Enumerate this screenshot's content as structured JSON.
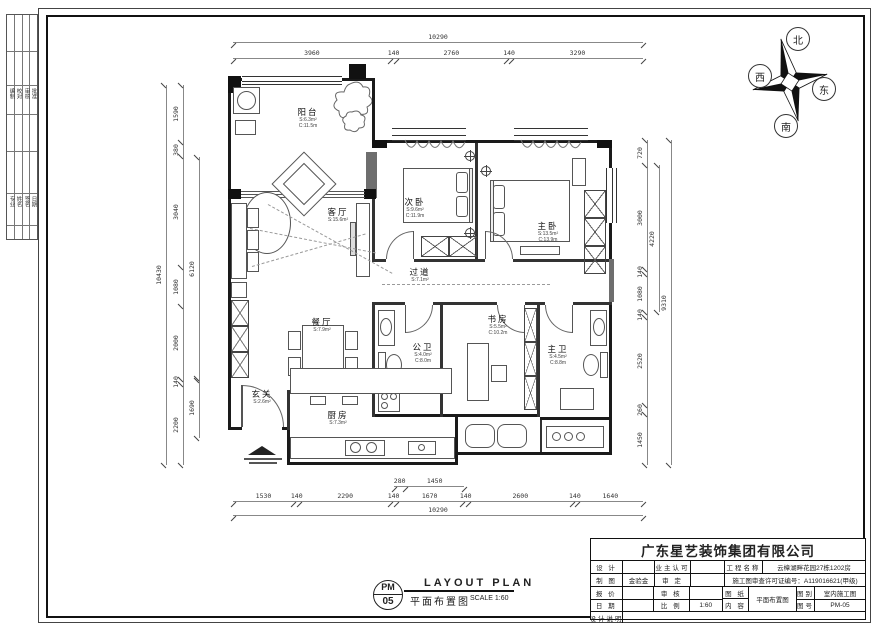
{
  "compass": {
    "north": "北",
    "south": "南",
    "east": "东",
    "west": "西"
  },
  "rooms": {
    "balcony": {
      "label": "阳台",
      "area": "S:6.3m²",
      "perim": "C:11.5m"
    },
    "living": {
      "label": "客厅",
      "area": "S:15.6m²",
      "perim": ""
    },
    "bedroom2": {
      "label": "次卧",
      "area": "S:9.6m²",
      "perim": "C:11.9m"
    },
    "master": {
      "label": "主卧",
      "area": "S:13.5m²",
      "perim": "C:13.9m"
    },
    "hall": {
      "label": "过道",
      "area": "S:7.1m²",
      "perim": ""
    },
    "dining": {
      "label": "餐厅",
      "area": "S:7.9m²",
      "perim": ""
    },
    "study": {
      "label": "书房",
      "area": "S:5.5m²",
      "perim": "C:10.2m"
    },
    "bath1": {
      "label": "公卫",
      "area": "S:4.0m²",
      "perim": "C:8.0m"
    },
    "bath2": {
      "label": "主卫",
      "area": "S:4.5m²",
      "perim": "C:8.8m"
    },
    "entry": {
      "label": "玄关",
      "area": "S:2.6m²",
      "perim": ""
    },
    "kitchen": {
      "label": "厨房",
      "area": "S:7.3m²",
      "perim": ""
    }
  },
  "dimensions": {
    "top": {
      "overall": [
        "10290"
      ],
      "segments": [
        "3960",
        "140",
        "2760",
        "140",
        "3290"
      ]
    },
    "bottom": {
      "overall": [
        "10290"
      ],
      "segments": [
        "1530",
        "140",
        "2290",
        "140",
        "1670",
        "140",
        "2600",
        "140",
        "1640"
      ],
      "sub": [
        "280",
        "1450"
      ]
    },
    "left": {
      "overall": [
        "10430"
      ],
      "segments": [
        "1590",
        "380",
        "3040",
        "1080",
        "2000",
        "140",
        "2200"
      ],
      "inner_a": [
        "6120"
      ],
      "inner_b": [
        "1690"
      ]
    },
    "right": {
      "overall": [
        "9310"
      ],
      "segments": [
        "720",
        "3000",
        "140",
        "1080",
        "140",
        "2520",
        "260",
        "1450"
      ],
      "inner": [
        "4220"
      ]
    }
  },
  "titleblock": {
    "company": "广东星艺装饰集团有限公司",
    "design_label": "设 计",
    "design_value": "",
    "owner_label": "业主认可",
    "owner_value": "",
    "project_label": "工程名称",
    "project_value": "云樟湖畔花园27栋1202房",
    "draft_label": "制 图",
    "draft_value": "金验金",
    "approve_label": "审 定",
    "approve_value": "",
    "license": "施工图审查许可证编号：A119016621(甲级)",
    "quote_label": "报 价",
    "quote_value": "",
    "check_label": "审 核",
    "check_value": "",
    "sheet_label": "图 纸",
    "content_label": "内 容",
    "sheet_value": "平面布置图",
    "type_label": "图别",
    "type_value": "室内施工图",
    "no_label": "图号",
    "no_value": "PM-05",
    "date_label": "日 期",
    "date_value": "",
    "scale_label": "比 例",
    "scale_value": "1:60",
    "note_label": "设计说明"
  },
  "footer": {
    "code_top": "PM",
    "code_bottom": "05",
    "title_en": "LAYOUT PLAN",
    "title_cn": "平面布置图",
    "scale": "SCALE 1:60"
  },
  "binding": {
    "g1": [
      "编制",
      "校对",
      "审核",
      "批准"
    ],
    "g2": [
      "专业",
      "姓名",
      "签名",
      "日期"
    ]
  }
}
